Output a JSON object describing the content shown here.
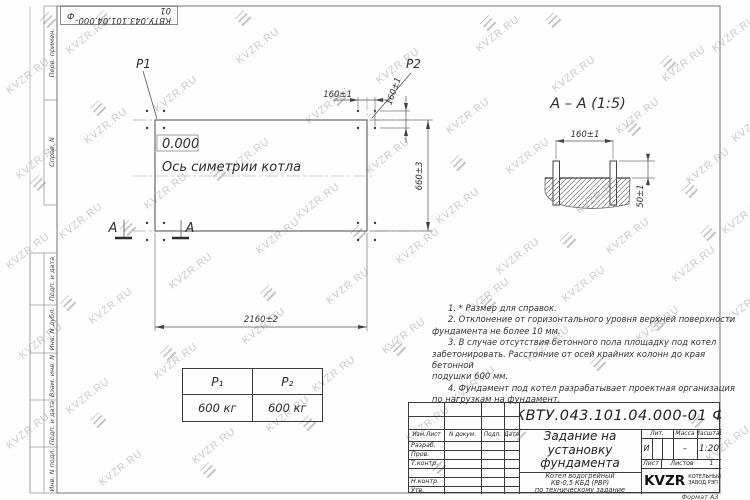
{
  "watermark": {
    "text": "KVZR.RU"
  },
  "stamp_top": {
    "number": "КВТУ.043.101.04.000-01",
    "letter": "Ф"
  },
  "margin_labels": [
    "Перв. примен.",
    "Справ. N",
    "Подп. и дата",
    "Инв. N дубл.",
    "Взам. инв. N",
    "Подп. и дата",
    "Инв. N подл."
  ],
  "plan": {
    "p1": "P1",
    "p2": "P2",
    "elevation": "0.000",
    "axis_label": "Ось симетрии котла",
    "dim_width": "2160±2",
    "dim_height": "660±3",
    "dim_bolt_spacing_x": "160±1",
    "dim_bolt_spacing_y": "160±1",
    "section_mark": "А"
  },
  "section": {
    "title": "А – А (1:5)",
    "dim_bolt_spacing": "160±1",
    "dim_bolt_height": "50±1"
  },
  "load_table": {
    "col1_header": "P₁",
    "col2_header": "P₂",
    "col1_value": "600 кг",
    "col2_value": "600 кг"
  },
  "notes": {
    "lines": [
      "1. * Размер для справок.",
      "2. Отклонение от горизонтального уровня верхней поверхности",
      "фундамента не более 10 мм.",
      "3. В случае отсутствия бетонного пола площадку под котел",
      "забетонировать. Расстояние от осей крайних колонн до края бетонной",
      "подушки 600 мм.",
      "4. Фундамент под котел разрабатывает проектная организация",
      "по нагрузкам на фундамент."
    ]
  },
  "title_block": {
    "doc_number": "КВТУ.043.101.04.000-01  Ф",
    "title_line1": "Задание на",
    "title_line2": "установку",
    "title_line3": "фундамента",
    "subtitle_line1": "Котел водогрейный",
    "subtitle_line2": "КВ-0,5 КБД (РВР)",
    "subtitle_line3": "по техническому задание",
    "rev_col1": "Изм.Лист",
    "rev_col2": "N докум.",
    "rev_col3": "Подп.",
    "rev_col4": "Дата",
    "row_developed": "Разраб.",
    "row_checked": "Пров.",
    "row_tcontrol": "Т.контр.",
    "row_ncontrol": "Н.контр.",
    "row_approved": "Утв.",
    "lit_label": "Лит.",
    "lit_value": "И",
    "mass_label": "Масса",
    "mass_value": "–",
    "scale_label": "Масштаб",
    "scale_value": "1:20",
    "sheet_label": "Лист",
    "sheets_label": "Листов",
    "sheets_value": "1",
    "company_name": "KVZR",
    "company_line1": "КОТЕЛЬНЫЙ",
    "company_line2": "ЗАВОД РЭП",
    "format_note": "Формат А3"
  }
}
